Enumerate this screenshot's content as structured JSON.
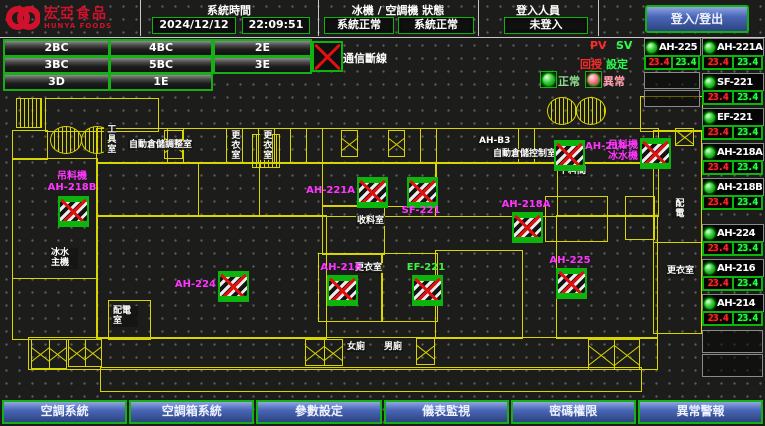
{
  "header": {
    "logo_line1": "宏亞食品",
    "logo_line2": "HUNYA FOODS",
    "time_label": "系統時間",
    "date": "2024/12/12",
    "time": "22:09:51",
    "status_label": "冰機 / 空調機 狀態",
    "chiller_status": "系統正常",
    "ac_status": "系統正常",
    "login_label": "登入人員",
    "login_status": "未登入",
    "login_button": "登入/登出"
  },
  "floor_buttons": [
    "2BC",
    "4BC",
    "2E",
    "3BC",
    "5BC",
    "3E",
    "3D",
    "1E"
  ],
  "legend": {
    "comm_loss": "通信斷線",
    "pv": "PV",
    "sv": "SV",
    "feedback": "回授",
    "setpoint": "設定",
    "normal": "正常",
    "abnormal": "異常"
  },
  "device_col_left": [
    {
      "name": "AH-225",
      "pv": "23.4",
      "sv": "23.4"
    }
  ],
  "device_col_right": [
    {
      "name": "AH-221A",
      "pv": "23.4",
      "sv": "23.4"
    },
    {
      "name": "SF-221",
      "pv": "23.4",
      "sv": "23.4"
    },
    {
      "name": "EF-221",
      "pv": "23.4",
      "sv": "23.4"
    },
    {
      "name": "AH-218A",
      "pv": "23.4",
      "sv": "23.4"
    },
    {
      "name": "AH-218B",
      "pv": "23.4",
      "sv": "23.4"
    },
    {
      "name": "AH-224",
      "pv": "23.4",
      "sv": "23.4"
    },
    {
      "name": "AH-216",
      "pv": "23.4",
      "sv": "23.4"
    },
    {
      "name": "AH-214",
      "pv": "23.4",
      "sv": "23.4"
    }
  ],
  "plan": {
    "rooms": [
      {
        "t": "工具室",
        "x": 104,
        "y": 124,
        "vertical": true
      },
      {
        "t": "自動倉儲調整室",
        "x": 128,
        "y": 140
      },
      {
        "t": "更衣室",
        "x": 228,
        "y": 130,
        "vertical": true
      },
      {
        "t": "更衣室",
        "x": 260,
        "y": 130,
        "vertical": true
      },
      {
        "t": "AH-B3",
        "x": 478,
        "y": 136
      },
      {
        "t": "自動倉儲控制室",
        "x": 492,
        "y": 149
      },
      {
        "t": "下料間",
        "x": 558,
        "y": 166
      },
      {
        "t": "收料室",
        "x": 356,
        "y": 216
      },
      {
        "t": "更衣室",
        "x": 354,
        "y": 263
      },
      {
        "t": "更衣室",
        "x": 666,
        "y": 266
      },
      {
        "t": "女廁",
        "x": 346,
        "y": 342
      },
      {
        "t": "男廁",
        "x": 383,
        "y": 342
      },
      {
        "t": "冰水主機",
        "x": 50,
        "y": 248,
        "w": 26
      },
      {
        "t": "配電室",
        "x": 112,
        "y": 306,
        "w": 24
      },
      {
        "t": "配電",
        "x": 672,
        "y": 198,
        "vertical": true
      }
    ],
    "devices": [
      {
        "label": "吊料機",
        "label2": "AH-218B",
        "x": 58,
        "y": 196,
        "pos": "above"
      },
      {
        "label": "AH-221A",
        "x": 357,
        "y": 177,
        "pos": "left"
      },
      {
        "label": "SF-221",
        "x": 407,
        "y": 177,
        "pos": "below"
      },
      {
        "label": "AH-218A",
        "x": 512,
        "y": 212,
        "pos": "above"
      },
      {
        "label": "AH-214",
        "x": 554,
        "y": 140,
        "pos": "right"
      },
      {
        "label": "吊料機",
        "label2": "冰水機",
        "x": 640,
        "y": 138,
        "pos": "left"
      },
      {
        "label": "AH-224",
        "x": 218,
        "y": 271,
        "pos": "left"
      },
      {
        "label": "AH-216",
        "x": 327,
        "y": 275,
        "pos": "above"
      },
      {
        "label": "EF-221",
        "x": 412,
        "y": 275,
        "pos": "above",
        "color": "#44ee44"
      },
      {
        "label": "AH-225",
        "x": 556,
        "y": 268,
        "pos": "above"
      }
    ]
  },
  "footer_buttons": [
    "空調系統",
    "空調箱系統",
    "參數設定",
    "儀表監視",
    "密碼權限",
    "異常警報"
  ],
  "colors": {
    "accent_green": "#15b015",
    "wall_yellow": "#d8d500",
    "alarm_red": "#e01010",
    "label_magenta": "#ff35ff",
    "button_blue": "#3a57a8"
  }
}
